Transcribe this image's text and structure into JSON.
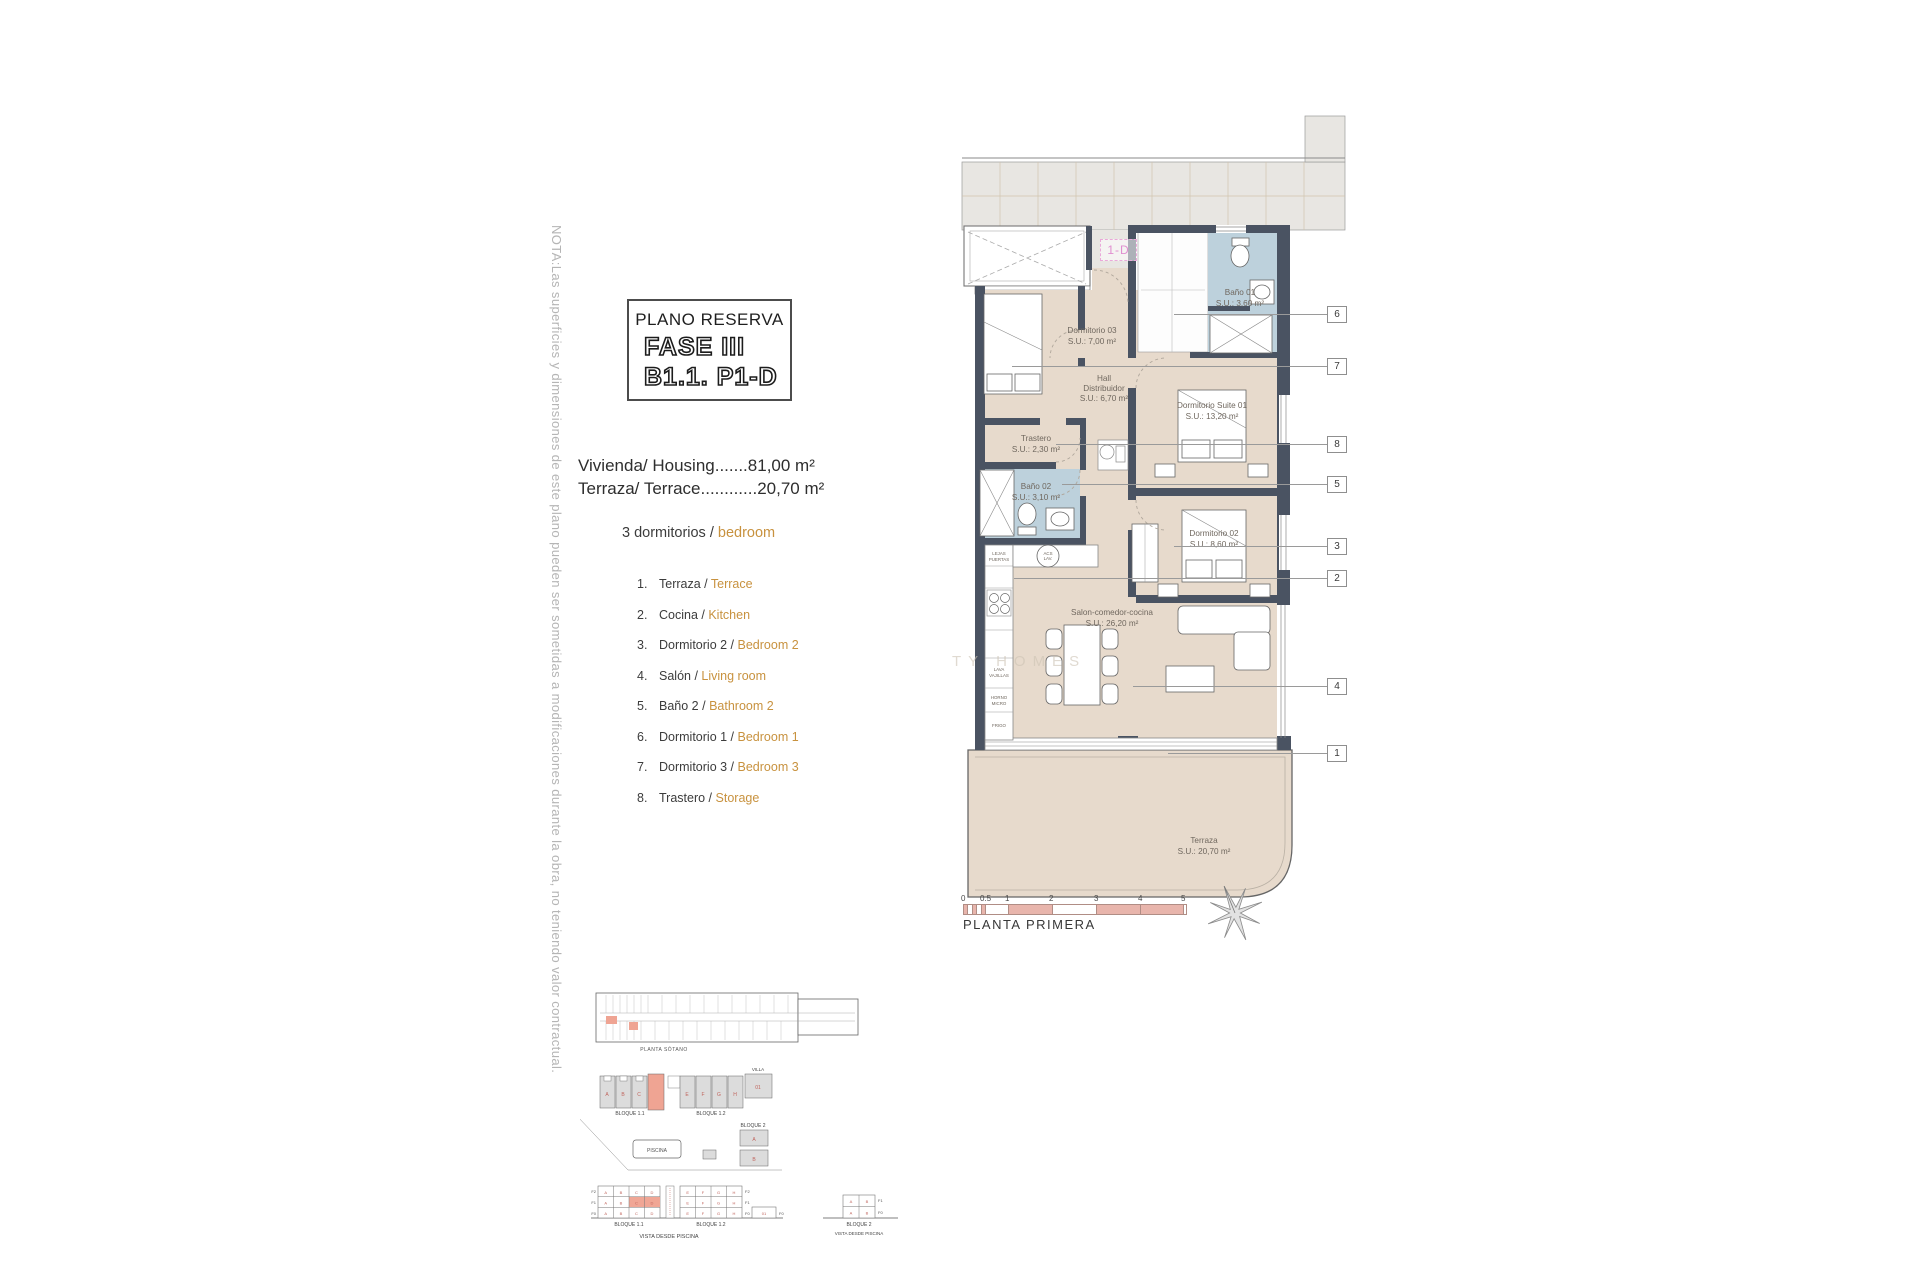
{
  "note": "NOTA:Las superficies y dimensiones de este plano pueden ser sometidas a modificaciones durante la obra, no teniendo valor contractual.",
  "title_block": {
    "line1": "PLANO RESERVA",
    "line2": "FASE III",
    "line3": "B1.1. P1-D"
  },
  "areas": {
    "housing": "Vivienda/ Housing.......81,00 m²",
    "terrace": "Terraza/ Terrace............20,70 m²",
    "bedrooms_es": "3 dormitorios /",
    "bedrooms_en": "bedroom"
  },
  "legend": [
    {
      "n": "1.",
      "es": "Terraza /",
      "en": "Terrace"
    },
    {
      "n": "2.",
      "es": "Cocina /",
      "en": "Kitchen"
    },
    {
      "n": "3.",
      "es": "Dormitorio 2 /",
      "en": "Bedroom 2"
    },
    {
      "n": "4.",
      "es": "Salón /",
      "en": "Living room"
    },
    {
      "n": "5.",
      "es": "Baño 2 /",
      "en": "Bathroom 2"
    },
    {
      "n": "6.",
      "es": "Dormitorio 1 /",
      "en": "Bedroom 1"
    },
    {
      "n": "7.",
      "es": "Dormitorio 3 /",
      "en": "Bedroom 3"
    },
    {
      "n": "8.",
      "es": "Trastero /",
      "en": "Storage"
    }
  ],
  "plan": {
    "unit": "1-D",
    "watermark": "TY HOMES",
    "rooms": {
      "dorm03": {
        "name": "Dormitorio 03",
        "area": "S.U.: 7,00 m²"
      },
      "hall": {
        "name1": "Hall",
        "name2": "Distribuidor",
        "area": "S.U.: 6,70 m²"
      },
      "bano01": {
        "name": "Baño 01",
        "area": "S.U.: 3,60 m²"
      },
      "suite": {
        "name": "Dormitorio Suite 01",
        "area": "S.U.: 13,20 m²"
      },
      "trastero": {
        "name": "Trastero",
        "area": "S.U.: 2,30 m²"
      },
      "bano02": {
        "name": "Baño 02",
        "area": "S.U.: 3,10 m²"
      },
      "dorm02": {
        "name": "Dormitorio 02",
        "area": "S.U.: 8,60 m²"
      },
      "salon": {
        "name": "Salon-comedor-cocina",
        "area": "S.U.: 26,20 m²"
      },
      "terraza": {
        "name": "Terraza",
        "area": "S.U.: 20,70 m²"
      }
    },
    "kitchen": {
      "k1a": "LAVA",
      "k1b": "VAJILLAS",
      "k2a": "HORNO",
      "k2b": "MICRO",
      "k3": "FRIGO",
      "sink1": "ACS",
      "sink2": "LAV.",
      "top1": "LEJAS",
      "top2": "PUERTAS"
    },
    "callouts": [
      "6",
      "7",
      "8",
      "5",
      "3",
      "2",
      "4",
      "1"
    ],
    "scale_ticks": [
      "0",
      "0.5",
      "1",
      "2",
      "3",
      "4",
      "5"
    ],
    "floor_label": "PLANTA PRIMERA"
  },
  "site": {
    "sotano": "PLANTA SÓTANO",
    "b11": "BLOQUE 1.1",
    "b12": "BLOQUE 1.2",
    "b2": "BLOQUE 2",
    "piscina": "PISCINA",
    "villa": "VILLA",
    "villa01": "01",
    "vista": "VISTA DESDE PISCINA",
    "f2": "F2",
    "f1": "F1",
    "f0": "F0",
    "letters": [
      "A",
      "B",
      "C",
      "D",
      "E",
      "F",
      "G",
      "H"
    ]
  },
  "colors": {
    "wall": "#4A5362",
    "floor_tan": "#E7DACC",
    "bath_blue": "#BDD1DC",
    "accent_orange": "#C8923F",
    "scale_pink": "#E8B5AC",
    "tag_pink": "#E08FD0",
    "site_red": "#C0645C",
    "highlight_salmon": "#EFA493"
  }
}
